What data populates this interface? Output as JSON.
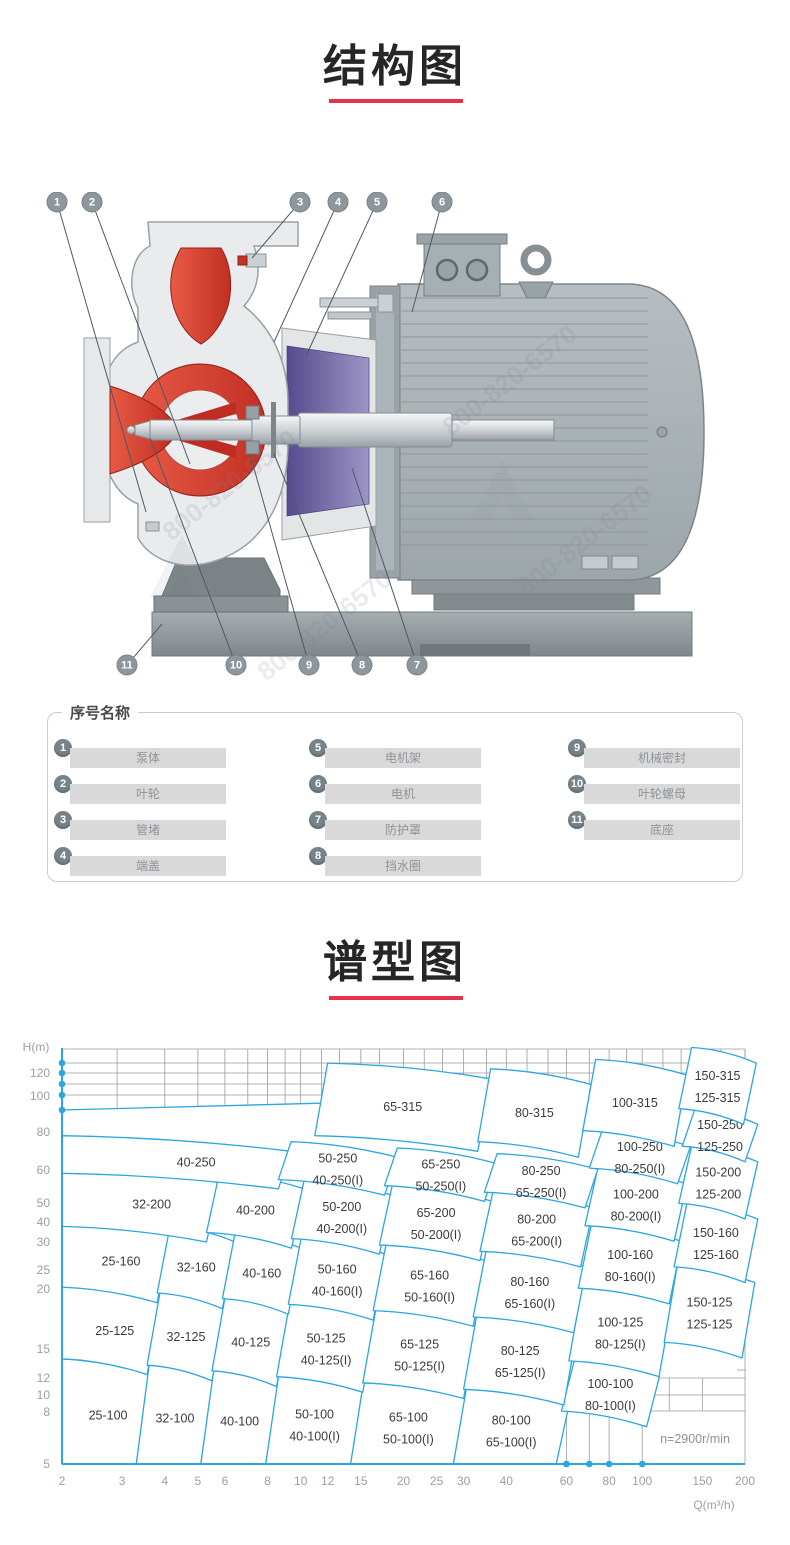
{
  "sections": {
    "structure": {
      "title": "结构图"
    },
    "type_chart": {
      "title": "谱型图"
    }
  },
  "accent_red": "#e6324a",
  "chart_blue": "#2ba6e0",
  "diagram": {
    "watermark": "800-820-6570",
    "callouts": [
      {
        "num": "1",
        "part": "泵体"
      },
      {
        "num": "2",
        "part": "叶轮"
      },
      {
        "num": "3",
        "part": "管堵"
      },
      {
        "num": "4",
        "part": "端盖"
      },
      {
        "num": "5",
        "part": "电机架"
      },
      {
        "num": "6",
        "part": "电机"
      },
      {
        "num": "7",
        "part": "防护罩"
      },
      {
        "num": "8",
        "part": "挡水圈"
      },
      {
        "num": "9",
        "part": "机械密封"
      },
      {
        "num": "10",
        "part": "叶轮螺母"
      },
      {
        "num": "11",
        "part": "底座"
      }
    ]
  },
  "parts_panel": {
    "legend": "序号名称",
    "items": [
      {
        "num": "1",
        "name": "泵体"
      },
      {
        "num": "2",
        "name": "叶轮"
      },
      {
        "num": "3",
        "name": "管堵"
      },
      {
        "num": "4",
        "name": "端盖"
      },
      {
        "num": "5",
        "name": "电机架"
      },
      {
        "num": "6",
        "name": "电机"
      },
      {
        "num": "7",
        "name": "防护罩"
      },
      {
        "num": "8",
        "name": "挡水圈"
      },
      {
        "num": "9",
        "name": "机械密封"
      },
      {
        "num": "10",
        "name": "叶轮螺母"
      },
      {
        "num": "11",
        "name": "底座"
      }
    ]
  },
  "chart_data": {
    "type": "region-map",
    "title": "谱型图",
    "xlabel": "Q(m³/h)",
    "ylabel": "H(m)",
    "scale": "log-log",
    "x_range": [
      2,
      200
    ],
    "y_range": [
      5,
      150
    ],
    "x_ticks": [
      2,
      3,
      4,
      5,
      6,
      8,
      10,
      12,
      15,
      20,
      25,
      30,
      40,
      60,
      80,
      100,
      150,
      200
    ],
    "y_ticks": [
      120,
      100,
      80,
      60,
      50,
      40,
      30,
      25,
      20,
      15,
      12,
      10,
      8,
      5
    ],
    "annotation": "n=2900r/min",
    "regions": [
      {
        "label": "25-100",
        "q": [
          2,
          3.3
        ],
        "h": [
          5,
          11.8
        ],
        "axis_left": true,
        "flat_bottom": true
      },
      {
        "label": "32-100",
        "q": [
          3.3,
          5.1
        ],
        "h": [
          5,
          11.2
        ],
        "flat_bottom": true
      },
      {
        "label": "40-100",
        "q": [
          5.1,
          7.9
        ],
        "h": [
          5,
          10.7
        ],
        "flat_bottom": true
      },
      {
        "label": "50-100",
        "label2": "40-100(I)",
        "q": [
          7.9,
          14
        ],
        "h": [
          5,
          10.2
        ],
        "flat_bottom": true
      },
      {
        "label": "65-100",
        "label2": "50-100(I)",
        "q": [
          14,
          28
        ],
        "h": [
          5,
          9.7
        ],
        "flat_bottom": true
      },
      {
        "label": "80-100",
        "label2": "65-100(I)",
        "q": [
          28,
          56
        ],
        "h": [
          5,
          9.2
        ],
        "flat_bottom": true
      },
      {
        "label": "100-100",
        "label2": "80-100(I)",
        "q": [
          58,
          103
        ],
        "h": [
          7.7,
          11.6
        ]
      },
      {
        "label": "25-125",
        "q": [
          2,
          3.55
        ],
        "h": [
          11.8,
          21.2
        ],
        "axis_left": true
      },
      {
        "label": "32-125",
        "q": [
          3.55,
          5.5
        ],
        "h": [
          11.2,
          20.2
        ]
      },
      {
        "label": "40-125",
        "q": [
          5.5,
          8.5
        ],
        "h": [
          10.7,
          19.3
        ]
      },
      {
        "label": "50-125",
        "label2": "40-125(I)",
        "q": [
          8.5,
          15.2
        ],
        "h": [
          10.2,
          18.4
        ]
      },
      {
        "label": "65-125",
        "label2": "50-125(I)",
        "q": [
          15.2,
          30
        ],
        "h": [
          9.7,
          17.5
        ]
      },
      {
        "label": "80-125",
        "label2": "65-125(I)",
        "q": [
          30,
          59
        ],
        "h": [
          9.2,
          16.6
        ]
      },
      {
        "label": "100-125",
        "label2": "80-125(I)",
        "q": [
          61,
          112
        ],
        "h": [
          11.6,
          21
        ]
      },
      {
        "label": "150-125",
        "label2": "125-125",
        "q": [
          116,
          196
        ],
        "h": [
          13.5,
          25
        ]
      },
      {
        "label": "25-160",
        "q": [
          2,
          3.8
        ],
        "h": [
          21.2,
          36.6
        ],
        "axis_left": true
      },
      {
        "label": "32-160",
        "q": [
          3.8,
          5.9
        ],
        "h": [
          20.2,
          34.8
        ]
      },
      {
        "label": "40-160",
        "q": [
          5.9,
          9.2
        ],
        "h": [
          19.3,
          33.1
        ]
      },
      {
        "label": "50-160",
        "label2": "40-160(I)",
        "q": [
          9.2,
          16.3
        ],
        "h": [
          18.4,
          31.5
        ]
      },
      {
        "label": "65-160",
        "label2": "50-160(I)",
        "q": [
          16.3,
          32
        ],
        "h": [
          17.5,
          29.9
        ]
      },
      {
        "label": "80-160",
        "label2": "65-160(I)",
        "q": [
          32,
          63
        ],
        "h": [
          16.6,
          28.4
        ]
      },
      {
        "label": "100-160",
        "label2": "80-160(I)",
        "q": [
          65,
          120
        ],
        "h": [
          21,
          35
        ]
      },
      {
        "label": "150-160",
        "label2": "125-160",
        "q": [
          124,
          200
        ],
        "h": [
          25,
          42
        ]
      },
      {
        "label": "32-200",
        "q": [
          2,
          5.3
        ],
        "h": [
          34.8,
          56.5
        ],
        "axis_left": true
      },
      {
        "label": "40-200",
        "q": [
          5.3,
          9.4
        ],
        "h": [
          33.1,
          53.7
        ]
      },
      {
        "label": "50-200",
        "label2": "40-200(I)",
        "q": [
          9.4,
          17
        ],
        "h": [
          31.5,
          51
        ]
      },
      {
        "label": "65-200",
        "label2": "50-200(I)",
        "q": [
          17,
          33.5
        ],
        "h": [
          29.9,
          48.5
        ]
      },
      {
        "label": "80-200",
        "label2": "65-200(I)",
        "q": [
          33.5,
          66
        ],
        "h": [
          28.4,
          46
        ]
      },
      {
        "label": "100-200",
        "label2": "80-200(I)",
        "q": [
          68,
          124
        ],
        "h": [
          35,
          56
        ]
      },
      {
        "label": "150-200",
        "label2": "125-200",
        "q": [
          128,
          200
        ],
        "h": [
          42,
          67
        ]
      },
      {
        "label": "40-250",
        "q": [
          2,
          8.6
        ],
        "h": [
          53.7,
          73
        ],
        "axis_left": true
      },
      {
        "label": "50-250",
        "label2": "40-250(I)",
        "q": [
          8.6,
          17.6
        ],
        "h": [
          51,
          69.5
        ]
      },
      {
        "label": "65-250",
        "label2": "50-250(I)",
        "q": [
          17.6,
          34.5
        ],
        "h": [
          48.5,
          66
        ]
      },
      {
        "label": "80-250",
        "label2": "65-250(I)",
        "q": [
          34.5,
          68
        ],
        "h": [
          46,
          63
        ]
      },
      {
        "label": "100-250",
        "label2": "80-250(I)",
        "q": [
          70,
          127
        ],
        "h": [
          56,
          76
        ]
      },
      {
        "label": "150-250",
        "label2": "125-250",
        "q": [
          131,
          200
        ],
        "h": [
          67,
          91
        ]
      },
      {
        "label": "65-315",
        "q": [
          11,
          33
        ],
        "h": [
          73,
          132
        ]
      },
      {
        "label": "80-315",
        "q": [
          33,
          65
        ],
        "h": [
          69.5,
          126
        ]
      },
      {
        "label": "100-315",
        "q": [
          67,
          124
        ],
        "h": [
          76,
          136
        ]
      },
      {
        "label": "150-315",
        "label2": "125-315",
        "q": [
          128,
          198
        ],
        "h": [
          91,
          150
        ]
      }
    ]
  }
}
